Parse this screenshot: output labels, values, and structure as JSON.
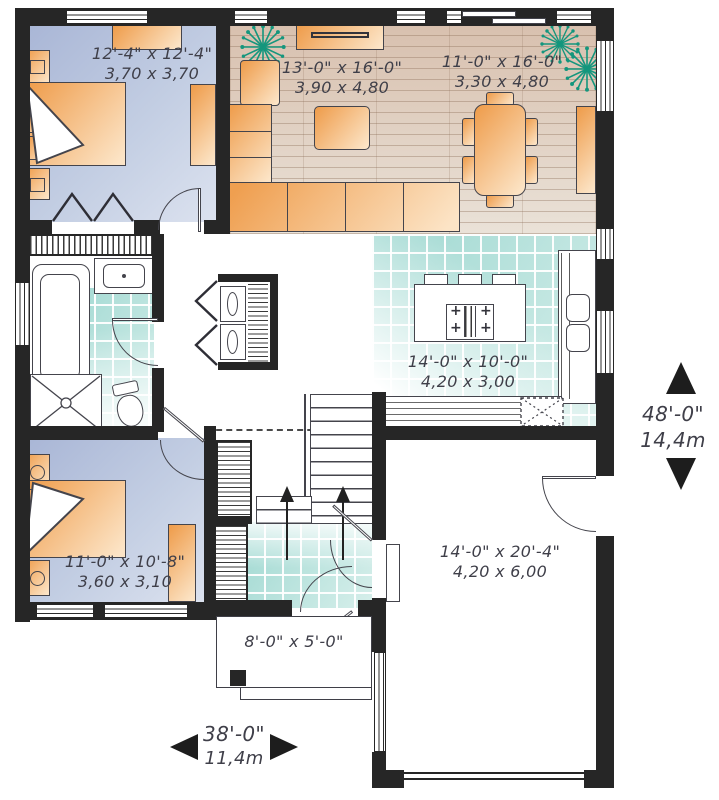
{
  "plan_title": "Single storey house floor plan",
  "rooms": {
    "bedroom1": {
      "imperial": "12'-4\" x 12'-4\"",
      "metric": "3,70 x 3,70"
    },
    "living": {
      "imperial": "13'-0\" x 16'-0\"",
      "metric": "3,90 x 4,80"
    },
    "dining": {
      "imperial": "11'-0\" x 16'-0\"",
      "metric": "3,30 x 4,80"
    },
    "kitchen": {
      "imperial": "14'-0\" x 10'-0\"",
      "metric": "4,20 x 3,00"
    },
    "bedroom2": {
      "imperial": "11'-0\" x 10'-8\"",
      "metric": "3,60 x 3,10"
    },
    "garage": {
      "imperial": "14'-0\" x 20'-4\"",
      "metric": "4,20 x 6,00"
    },
    "porch": {
      "imperial": "8'-0\" x 5'-0\""
    }
  },
  "overall_dimensions": {
    "depth": {
      "imperial": "48'-0\"",
      "metric": "14,4m"
    },
    "width": {
      "imperial": "38'-0\"",
      "metric": "11,4m"
    }
  },
  "icons": {
    "plant": "plant-icon",
    "stairs_direction": "up-arrow"
  },
  "colors": {
    "wall": "#262626",
    "bedroom_floor": "#b6c2dd",
    "wood_floor": "#d8c0ae",
    "tile_floor": "#a8ddd6",
    "furniture": "#f0a45c",
    "plant": "#14967d",
    "text": "#3f3f49"
  }
}
